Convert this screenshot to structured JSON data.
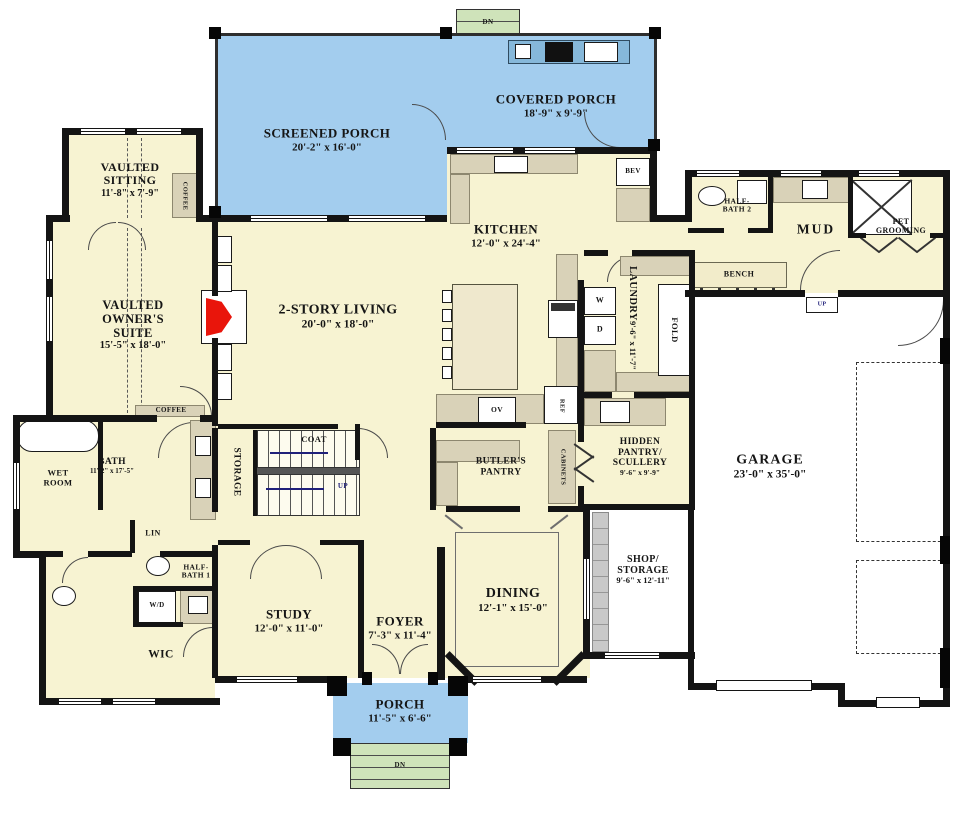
{
  "title": "First Floor Plan",
  "colors": {
    "floor": "#f7f3d2",
    "porch_blue": "#a3cdee",
    "steps_green": "#cfe3ba",
    "counter_tan": "#d9d2b8",
    "wall_black": "#141414",
    "fireplace_red": "#e9150b",
    "garage_floor": "#ffffff",
    "outdoor_counter": "#86b8da"
  },
  "rooms": {
    "screened_porch": {
      "name": "SCREENED PORCH",
      "dims": "20'-2\" x 16'-0\""
    },
    "covered_porch": {
      "name": "COVERED PORCH",
      "dims": "18'-9\" x 9'-9\""
    },
    "vaulted_sitting": {
      "name": "VAULTED SITTING",
      "dims": "11'-8\" x 7'-9\""
    },
    "owners_suite": {
      "name": "VAULTED OWNER'S SUITE",
      "dims": "15'-5\" x 18'-0\""
    },
    "bath": {
      "name": "BATH",
      "dims": "11'-2\" x 17'-5\""
    },
    "wet_room": {
      "name": "WET ROOM"
    },
    "wic": {
      "name": "WIC"
    },
    "study": {
      "name": "STUDY",
      "dims": "12'-0\" x 11'-0\""
    },
    "foyer": {
      "name": "FOYER",
      "dims": "7'-3\" x 11'-4\""
    },
    "dining": {
      "name": "DINING",
      "dims": "12'-1\" x 15'-0\""
    },
    "porch": {
      "name": "PORCH",
      "dims": "11'-5\" x 6'-6\""
    },
    "living": {
      "name": "2-STORY LIVING",
      "dims": "20'-0\" x 18'-0\""
    },
    "kitchen": {
      "name": "KITCHEN",
      "dims": "12'-0\" x 24'-4\""
    },
    "laundry": {
      "name": "LAUNDRY",
      "dims": "9'-6\" x 11'-7\""
    },
    "butlers_pantry": {
      "name": "BUTLER'S PANTRY"
    },
    "hidden_pantry": {
      "name": "HIDDEN PANTRY/ SCULLERY",
      "dims": "9'-6\" x 9'-9\""
    },
    "mud": {
      "name": "MUD"
    },
    "half_bath_1": {
      "name": "HALF-BATH 1"
    },
    "half_bath_2": {
      "name": "HALF-BATH 2"
    },
    "pet_grooming": {
      "name": "PET GROOMING"
    },
    "garage": {
      "name": "GARAGE",
      "dims": "23'-0\" x 35'-0\""
    },
    "shop": {
      "name": "SHOP/ STORAGE",
      "dims": "9'-6\" x 12'-11\""
    }
  },
  "labels": {
    "dn": "DN",
    "up": "UP",
    "coffee": "COFFEE",
    "storage": "STORAGE",
    "coat": "COAT",
    "bev": "BEV",
    "washer": "W",
    "dryer": "D",
    "fold": "FOLD",
    "ov": "OV",
    "ref": "REF",
    "cabinets": "CABINETS",
    "bench": "BENCH",
    "lin": "LIN",
    "wd": "W/D"
  }
}
